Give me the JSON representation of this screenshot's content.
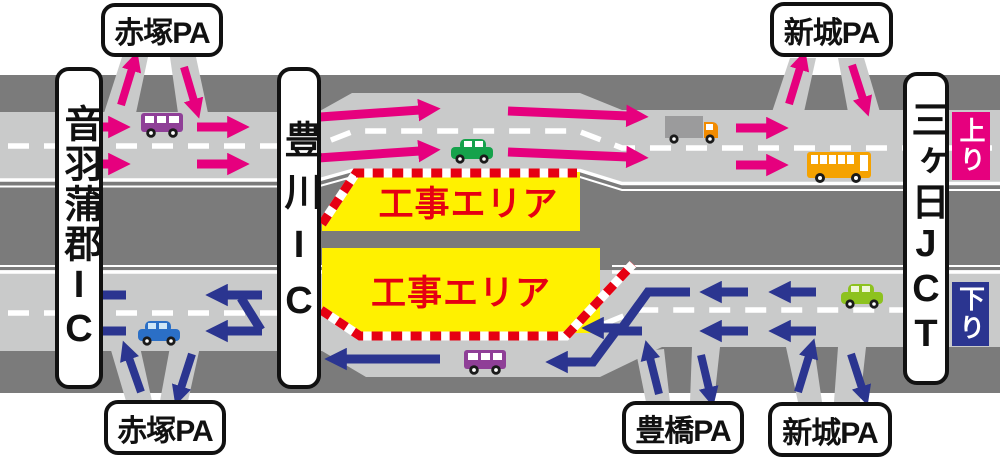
{
  "corridor": {
    "left_ic": {
      "label": "音羽蒲郡IC"
    },
    "middle_ic": {
      "label": "豊川IC"
    },
    "right_jct": {
      "label": "三ヶ日JCT"
    },
    "up_line": {
      "badge": "上り",
      "badge_color": "#e6007e",
      "flow": "right",
      "arrow_color": "#e6007e",
      "pa_top_left": {
        "label": "赤塚PA"
      },
      "pa_top_right": {
        "label": "新城PA"
      }
    },
    "down_line": {
      "badge": "下り",
      "badge_color": "#2b3590",
      "flow": "left",
      "arrow_color": "#2b3590",
      "pa_bottom_left": {
        "label": "赤塚PA"
      },
      "pa_bottom_middle": {
        "label": "豊橋PA"
      },
      "pa_bottom_right": {
        "label": "新城PA"
      }
    },
    "construction_zones": [
      {
        "line": "up",
        "label": "工事エリア"
      },
      {
        "line": "down",
        "label": "工事エリア"
      }
    ]
  },
  "colors": {
    "background": "#ffffff",
    "ground": "#7b7b7b",
    "road": "#c9caca",
    "lane_marking": "#ffffff",
    "up_arrow": "#e6007e",
    "down_arrow": "#2b3590",
    "construction_fill": "#fff100",
    "construction_border": "#e60012",
    "construction_text": "#e60012"
  },
  "vehicles": [
    {
      "type": "van",
      "color": "#8f3f97",
      "line": "up"
    },
    {
      "type": "car",
      "color": "#15a24b",
      "line": "up"
    },
    {
      "type": "truck",
      "color": "#9b9b9c",
      "cab_color": "#f28b00",
      "line": "up"
    },
    {
      "type": "bus",
      "color": "#f5a200",
      "line": "up"
    },
    {
      "type": "car",
      "color": "#2b6fc6",
      "line": "down"
    },
    {
      "type": "car",
      "color": "#8dc21f",
      "line": "down"
    },
    {
      "type": "van",
      "color": "#8f3f97",
      "line": "down"
    }
  ]
}
